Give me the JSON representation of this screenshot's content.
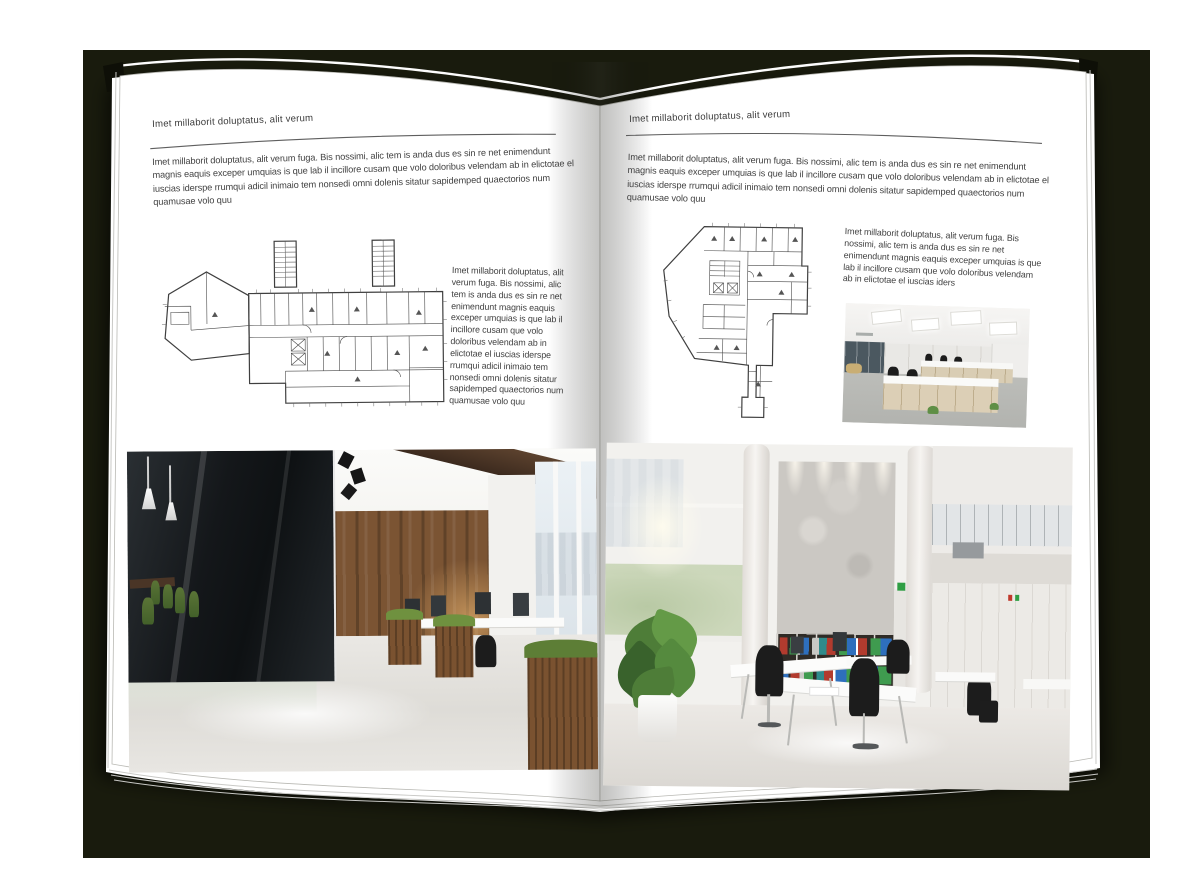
{
  "colors": {
    "backdrop": "#191b0d",
    "page": "#ffffff",
    "text": "#414141",
    "rule": "#5f5f5f",
    "plan_line": "#4a4a4a",
    "wood_wall": "#7b5433",
    "meeting_chair_green": "#55742f",
    "binder_red": "#b23b2e",
    "binder_green": "#3f9b4f",
    "binder_blue": "#2e6fbd"
  },
  "left_page": {
    "header": "Imet millaborit doluptatus, alit verum",
    "intro": "Imet millaborit doluptatus, alit verum fuga. Bis nossimi, alic tem is anda dus es sin re net enimendunt magnis eaquis exceper umquias is que lab il incillore cusam que volo doloribus velendam ab in elictotae el iuscias iderspe rrumqui adicil inimaio tem nonsedi omni dolenis sitatur sapidemped quaectorios num quamusae volo quu",
    "column": "Imet millaborit doluptatus, alit verum fuga. Bis nossimi, alic tem is anda dus es sin re net enimendunt magnis eaquis exceper umquias is que lab il incillore cusam que volo doloribus velendam ab in elictotae el iuscias iderspe rrumqui adicil inimaio tem nonsedi omni dolenis sitatur sapidemped quaectorios num quamusae volo quu"
  },
  "right_page": {
    "header": "Imet millaborit doluptatus, alit verum",
    "intro": "Imet millaborit doluptatus, alit verum fuga. Bis nossimi, alic tem is anda dus es sin re net enimendunt magnis eaquis exceper umquias is que lab il incillore cusam que volo doloribus velendam ab in elictotae el iuscias iderspe rrumqui adicil inimaio tem nonsedi omni dolenis sitatur sapidemped quaectorios num quamusae volo quu",
    "column": "Imet millaborit doluptatus, alit verum fuga. Bis nossimi, alic tem is anda dus es sin re net enimendunt magnis eaquis exceper umquias is que lab il incillore cusam que volo doloribus velendam ab in elictotae el iuscias iders"
  }
}
